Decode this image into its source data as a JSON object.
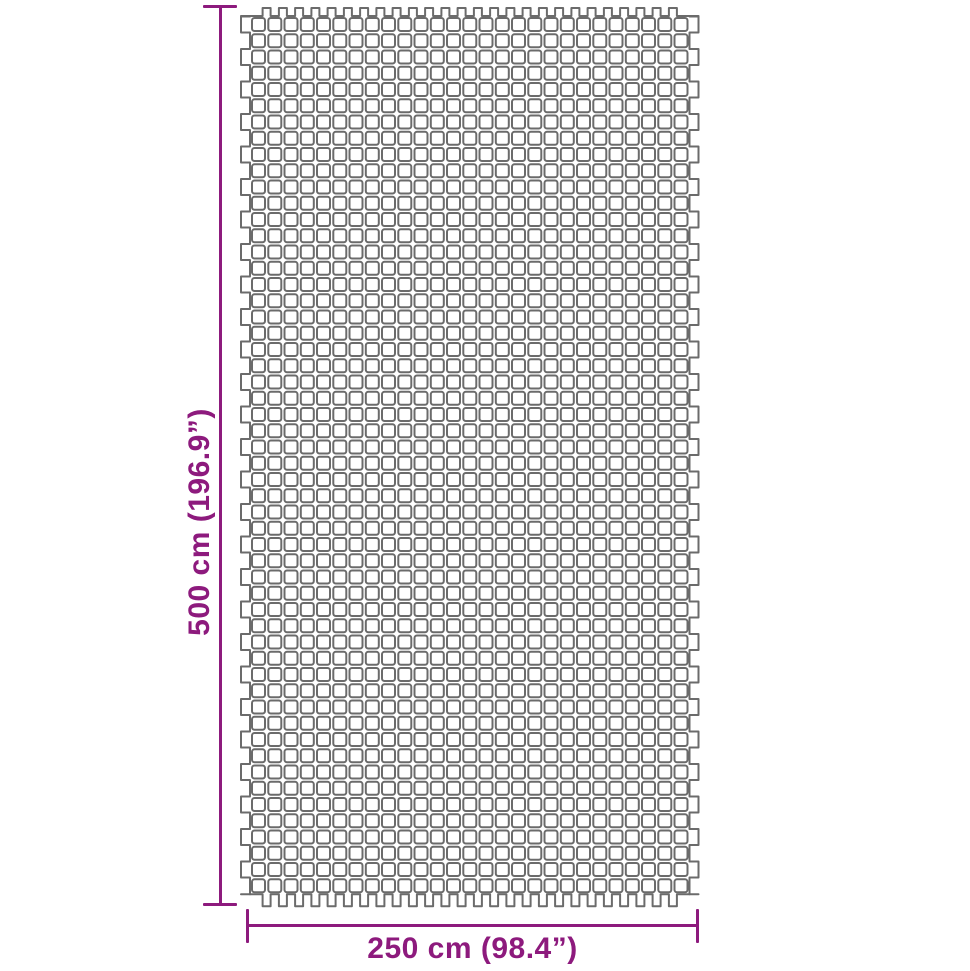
{
  "diagram": {
    "title": "ground mat dimension diagram",
    "height_dimension": {
      "label": "500 cm (196.9”)"
    },
    "width_dimension": {
      "label": "250 cm (98.4”)"
    },
    "colors": {
      "accent": "#8D1A7D",
      "mesh_stroke": "#6B6B6B",
      "background": "#FFFFFF"
    },
    "mesh": {
      "rows": 54,
      "cols": 27
    }
  }
}
